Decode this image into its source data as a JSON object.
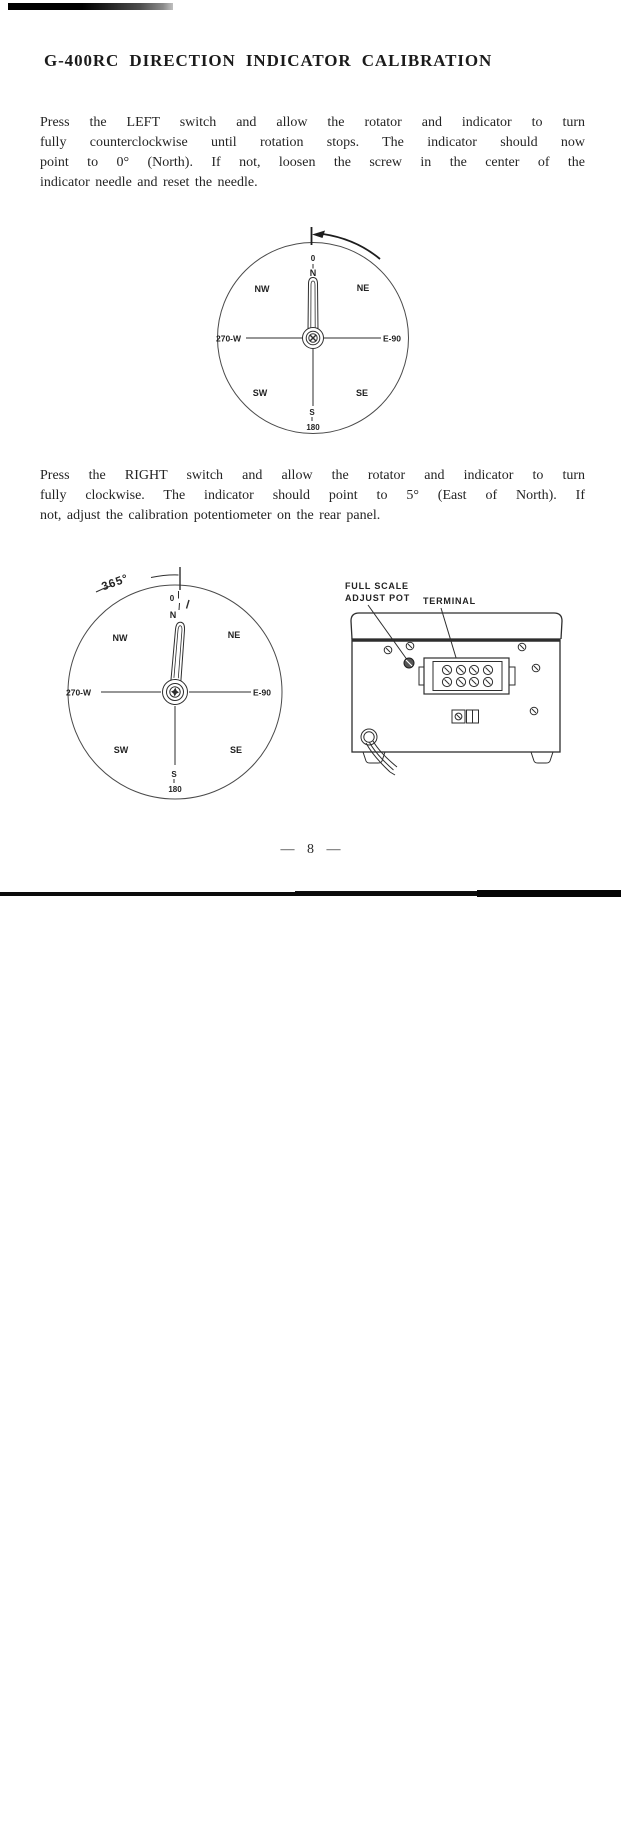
{
  "doc": {
    "title": "G-400RC DIRECTION INDICATOR CALIBRATION",
    "page_number": "— 8 —",
    "paragraph1": {
      "lines": [
        "Press the LEFT switch and allow the rotator and indicator to turn",
        "fully counterclockwise until rotation stops. The indicator should now",
        "point to 0° (North). If not, loosen the screw in the center of the",
        "indicator needle and reset the needle."
      ]
    },
    "paragraph2": {
      "lines": [
        "Press the RIGHT switch and allow the rotator and indicator to turn",
        "fully clockwise. The indicator should point to 5° (East of North). If",
        "not, adjust the calibration potentiometer on the rear panel."
      ]
    }
  },
  "compass1": {
    "labels": {
      "top_deg": "0",
      "n": "N",
      "nw": "NW",
      "ne": "NE",
      "w": "270-W",
      "e": "E-90",
      "sw": "SW",
      "se": "SE",
      "s": "S",
      "s_deg": "180"
    }
  },
  "compass2": {
    "angle_label": "365°",
    "labels": {
      "top_deg": "0",
      "n": "N",
      "nw": "NW",
      "ne": "NE",
      "w": "270-W",
      "e": "E-90",
      "sw": "SW",
      "se": "SE",
      "s": "S",
      "s_deg": "180"
    }
  },
  "rear_panel": {
    "labels": {
      "full_scale": "FULL SCALE",
      "adjust_pot": "ADJUST POT",
      "terminal": "TERMINAL"
    }
  },
  "colors": {
    "ink": "#1f1f1f",
    "paper": "#ffffff"
  }
}
